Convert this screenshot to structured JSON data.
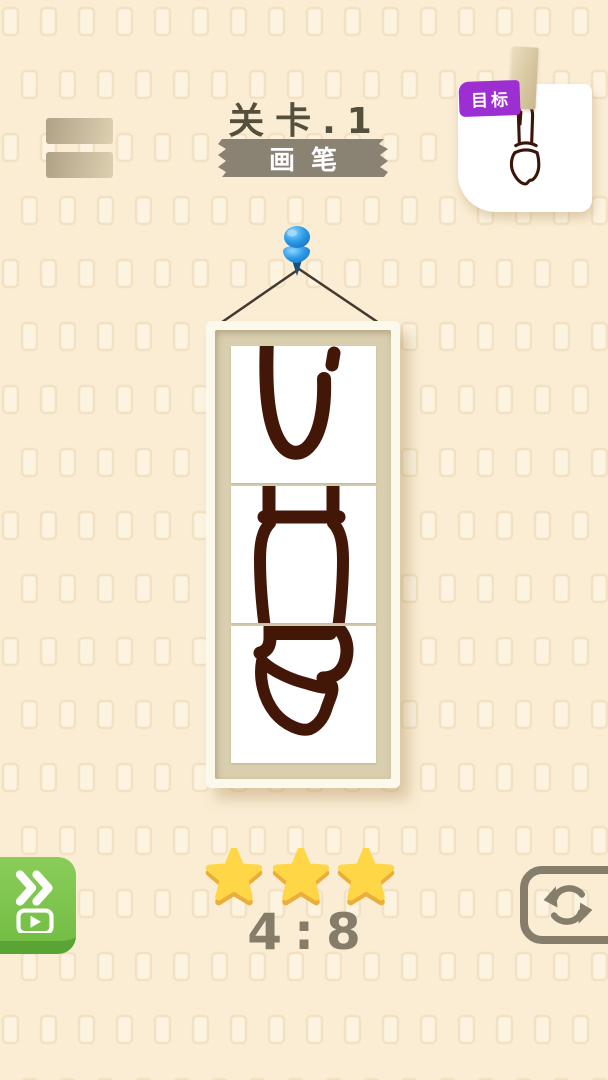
{
  "header": {
    "level_label": "关卡.1",
    "subject_label": "画笔",
    "goal_badge_label": "目标"
  },
  "puzzle": {
    "pieces_count": 3,
    "description": "paintbrush drawing split into 3 vertical slices, pieces currently rotated"
  },
  "footer": {
    "score": "4:8",
    "stars": 3
  },
  "icons": {
    "menu": "two-bar-menu",
    "goal_clip": "tape-clip",
    "pin": "blue-pushpin",
    "skip": "double-chevron-with-play",
    "star": "gold-star",
    "reset": "refresh-cycle-arrows"
  },
  "colors": {
    "background": "#FAEDD4",
    "pattern_tile": "#FCF3E0",
    "ink": "#431708",
    "title_text": "#54503D",
    "ribbon": "#8A8272",
    "badge": "#9D2FD2",
    "card": "#FFFFFF",
    "frame_border": "#FBF8EC",
    "frame_mat": "#D9CFAF",
    "pin_blue": "#2D9BE8",
    "string": "#43392E",
    "skip_green": "#74BE45",
    "skip_green_dark": "#5AA335",
    "star_gold": "#FFD646",
    "star_gold_dark": "#E9AE3B",
    "score_text": "#857D69",
    "reset_outline": "#867E6B"
  }
}
